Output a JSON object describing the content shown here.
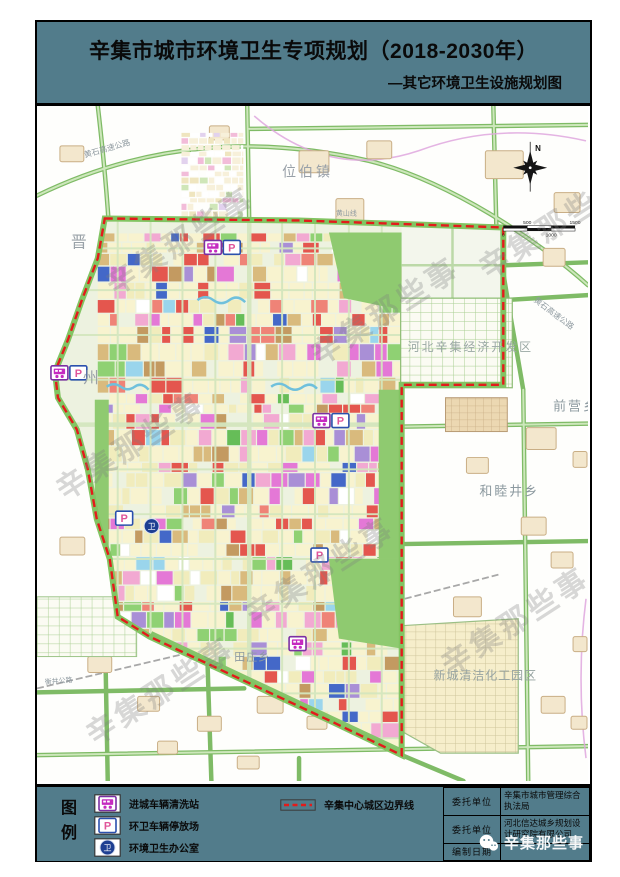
{
  "watermark": {
    "text": "辛集那些事"
  },
  "header": {
    "title": "辛集市城市环境卫生专项规划（2018-2030年）",
    "subtitle": "—其它环境卫生设施规划图"
  },
  "map": {
    "compass_n": "N",
    "scale_ticks": {
      "t0": "0",
      "t500": "500",
      "t1000": "1000",
      "t1500": "1500"
    },
    "labels": {
      "town_weibo": "位伯镇",
      "jin": "晋",
      "zhou": "州",
      "dev_zone": "河北辛集经济开发区",
      "town_qianying": "前营乡",
      "town_hemujing": "和睦井乡",
      "town_tianzhuang": "田庄乡",
      "chem_park": "新城清洁化工园区",
      "expressway": "黄石高速公路",
      "road_hengjing": "衡井公路",
      "road_huangshan": "黄山线"
    },
    "marker_glyphs": {
      "parking": "P",
      "office": "卫"
    }
  },
  "legend": {
    "title": "图例",
    "items": [
      {
        "label": "进城车辆清洗站"
      },
      {
        "label": "环卫车辆停放场"
      },
      {
        "label": "环境卫生办公室"
      }
    ],
    "boundary_label": "辛集中心城区边界线"
  },
  "info_table": {
    "rows": [
      {
        "key": "委托单位",
        "value": "辛集市城市管理综合执法局"
      },
      {
        "key": "委托单位",
        "value": "河北信达城乡规划设计研究院有限公司"
      },
      {
        "key": "编制日期",
        "value": ""
      }
    ]
  },
  "footer_badge": {
    "text": "辛集那些事"
  }
}
